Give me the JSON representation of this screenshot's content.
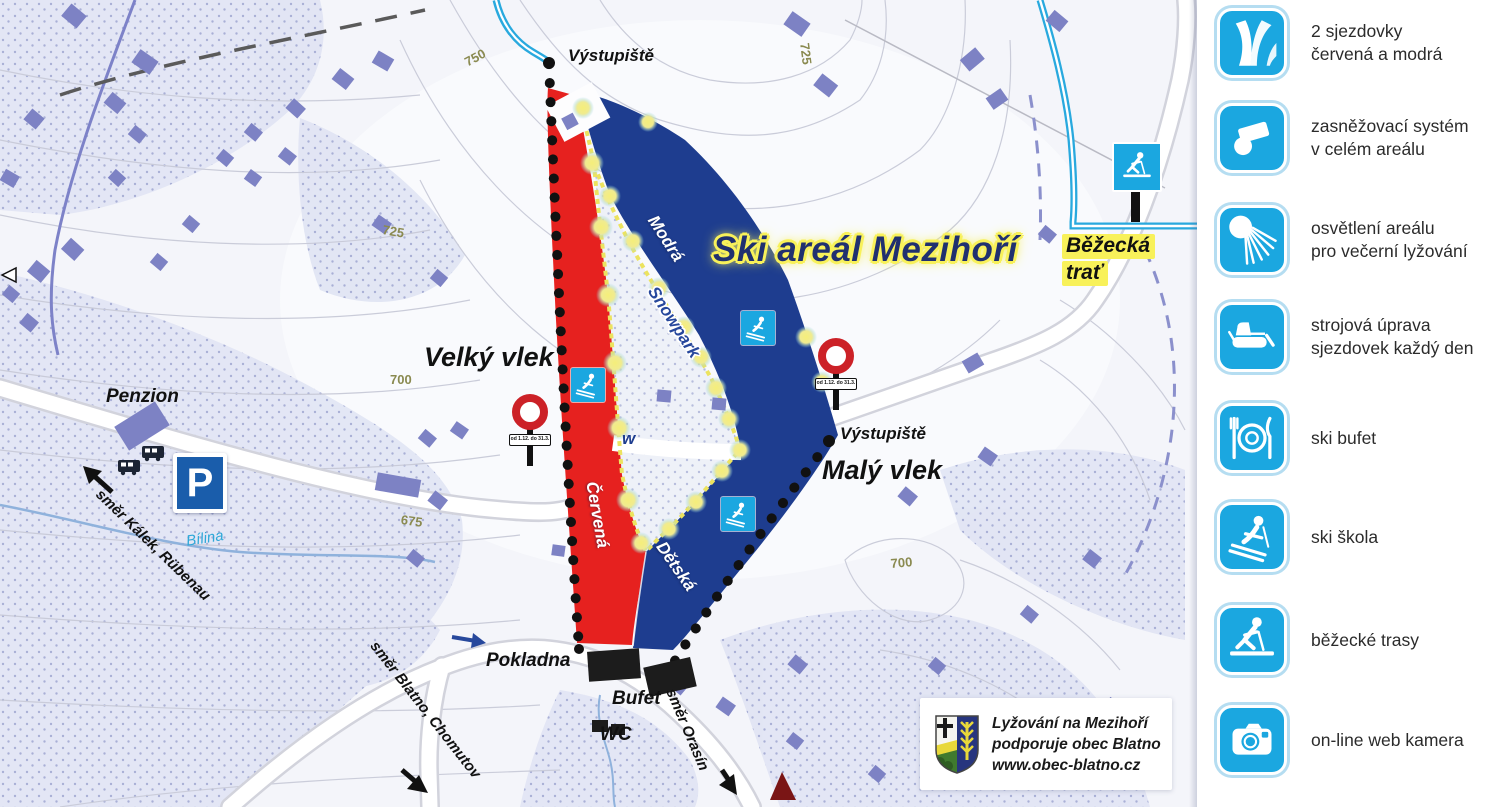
{
  "map": {
    "title": "Ski areál Mezihoří",
    "slopes": {
      "cervena": "Červená",
      "modra": "Modrá",
      "detska": "Dětská",
      "snowpark": "Snowpark"
    },
    "lifts": {
      "velky": "Velký vlek",
      "maly": "Malý vlek",
      "vystupiste_top": "Výstupiště",
      "vystupiste_maly": "Výstupiště"
    },
    "places": {
      "pokladna": "Pokladna",
      "bufet": "Bufet",
      "wc": "WC",
      "penzion": "Penzion",
      "parking": "P"
    },
    "directions": {
      "kalek": "směr Kálek, Rübenau",
      "blatno": "směr Blatno, Chomutov",
      "orasin": "směr Orasín"
    },
    "trail": {
      "line1": "Běžecká",
      "line2": "trať"
    },
    "stream_label": "Bílina",
    "sign_plate": "od 1.12. do 31.3.",
    "contour_labels": [
      "750",
      "725",
      "725",
      "700",
      "675",
      "700"
    ],
    "colors": {
      "red_slope": "#e6211f",
      "blue_slope": "#1e3d8f",
      "accent_cyan": "#1ba7e0",
      "title_blue": "#20306f",
      "highlight_yellow": "#f8f15a",
      "building_purple": "#7d82c4"
    }
  },
  "legend": {
    "items": [
      {
        "icon": "piste-icon",
        "line1": "2 sjezdovky",
        "line2": "červená a modrá"
      },
      {
        "icon": "snow-cannon-icon",
        "line1": "zasněžovací systém",
        "line2": "v celém areálu"
      },
      {
        "icon": "floodlight-icon",
        "line1": "osvětlení areálu",
        "line2": "pro večerní lyžování"
      },
      {
        "icon": "snow-groomer-icon",
        "line1": "strojová úprava",
        "line2": "sjezdovek každý den"
      },
      {
        "icon": "ski-buffet-icon",
        "line1": "ski bufet",
        "line2": ""
      },
      {
        "icon": "ski-school-icon",
        "line1": "ski škola",
        "line2": ""
      },
      {
        "icon": "cross-country-icon",
        "line1": "běžecké trasy",
        "line2": ""
      },
      {
        "icon": "webcam-icon",
        "line1": "on-line web kamera",
        "line2": ""
      }
    ]
  },
  "sponsor": {
    "line1": "Lyžování na Mezihoří",
    "line2": "podporuje obec Blatno",
    "line3": "www.obec-blatno.cz"
  }
}
